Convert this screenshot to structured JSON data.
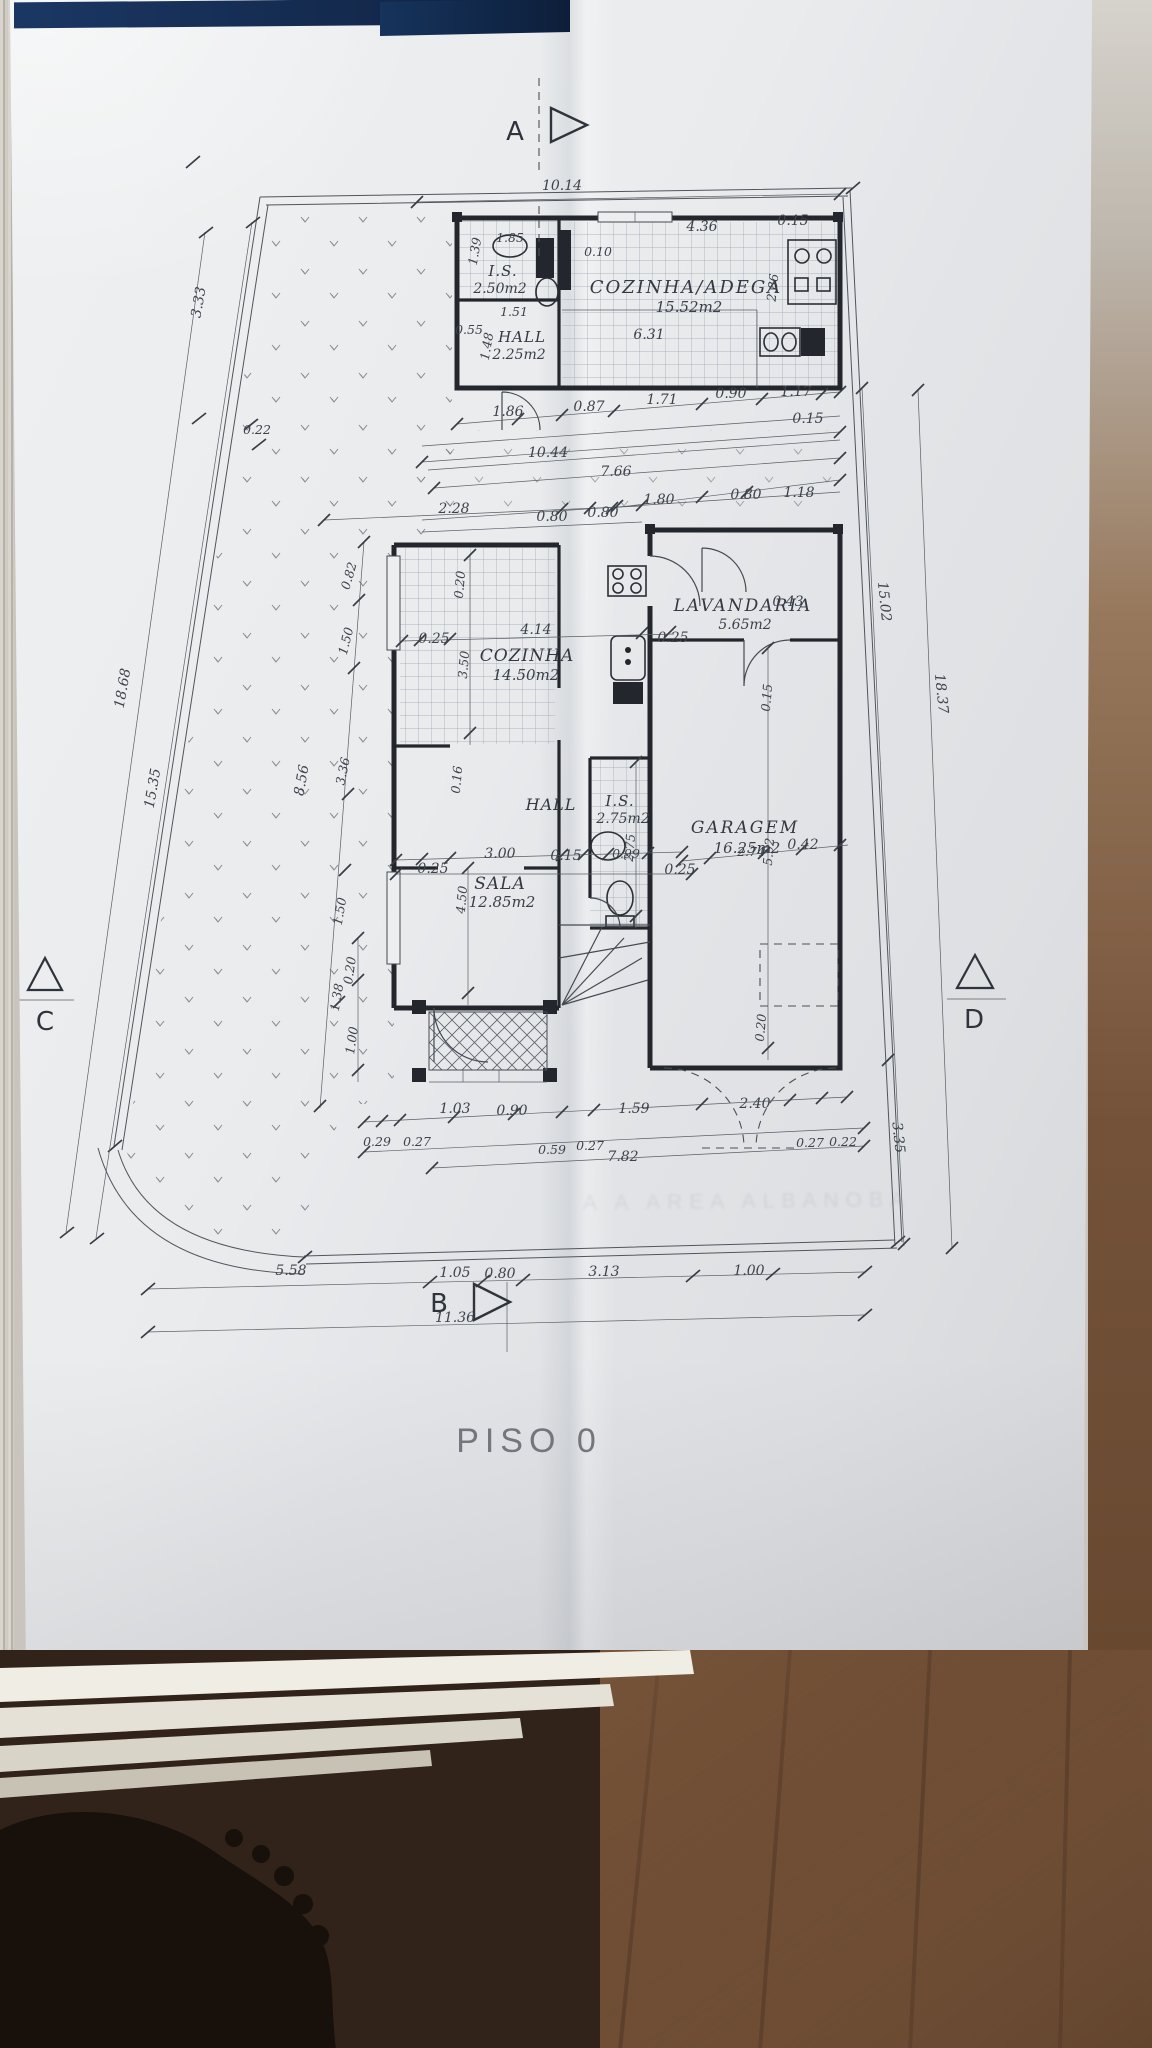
{
  "title": {
    "floor_label": "PISO 0"
  },
  "stamp": {
    "text": "A A   AREA   ALBANOBA"
  },
  "markers": {
    "a": "A",
    "b": "B",
    "c": "C",
    "d": "D"
  },
  "rooms": {
    "is_top": {
      "name": "I.S.",
      "area": "2.50m2"
    },
    "hall_top": {
      "name": "HALL",
      "area": "2.25m2"
    },
    "adega": {
      "name": "COZINHA/ADEGA",
      "area": "15.52m2"
    },
    "cozinha": {
      "name": "COZINHA",
      "area": "14.50m2"
    },
    "lavandaria": {
      "name": "LAVANDARIA",
      "area": "5.65m2"
    },
    "hall_mid": {
      "name": "HALL"
    },
    "is_mid": {
      "name": "I.S.",
      "area": "2.75m2"
    },
    "sala": {
      "name": "SALA",
      "area": "12.85m2"
    },
    "garagem": {
      "name": "GARAGEM",
      "area": "16.25m2"
    }
  },
  "dims": {
    "t1": "10.14",
    "u1": "1.39",
    "u2": "1.85",
    "u3": "0.10",
    "u4": "1.51",
    "u5": "0.55",
    "u6": "1.48",
    "u7": "4.36",
    "u8": "0.15",
    "u9": "2.86",
    "u10": "6.31",
    "r1": "1.86",
    "r2": "0.87",
    "r3": "1.71",
    "r4": "0.90",
    "r5": "1.17",
    "r6": "0.15",
    "r7": "10.44",
    "r8": "7.66",
    "r9": "1.80",
    "r10": "0.80",
    "r11": "1.18",
    "r12": "2.28",
    "r13": "0.80",
    "r14": "0.80",
    "l1": "3.33",
    "l2": "0.22",
    "l3": "18.68",
    "l4": "15.35",
    "l5": "8.56",
    "l6": "0.82",
    "l7": "1.50",
    "l8": "3.36",
    "l9": "1.50",
    "l10": "1.38",
    "l11": "0.16",
    "l12": "0.20",
    "l13": "1.00",
    "k1": "4.14",
    "k2": "0.20",
    "k3": "0.25",
    "k4": "3.50",
    "k5": "0.25",
    "v1": "0.43",
    "v3": "0.15",
    "m1": "3.00",
    "m2": "0.15",
    "m3": "0.25",
    "m4": "4.50",
    "m5": "2.75",
    "m6": "0.99",
    "m8": "0.25",
    "m9": "0.42",
    "m10": "2.74",
    "m11": "5.92",
    "m12": "0.20",
    "g1": "15.02",
    "g2": "18.37",
    "g3": "3.35",
    "b1": "1.03",
    "b2": "0.90",
    "b3": "1.59",
    "b4": "2.40",
    "b5": "0.29",
    "b6": "0.27",
    "b7": "0.59",
    "b8": "0.27",
    "b9": "7.82",
    "b10": "0.27",
    "b11": "0.22",
    "c1": "5.58",
    "c2": "1.05",
    "c3": "0.80",
    "c4": "3.13",
    "c5": "1.00",
    "c6": "11.36"
  }
}
